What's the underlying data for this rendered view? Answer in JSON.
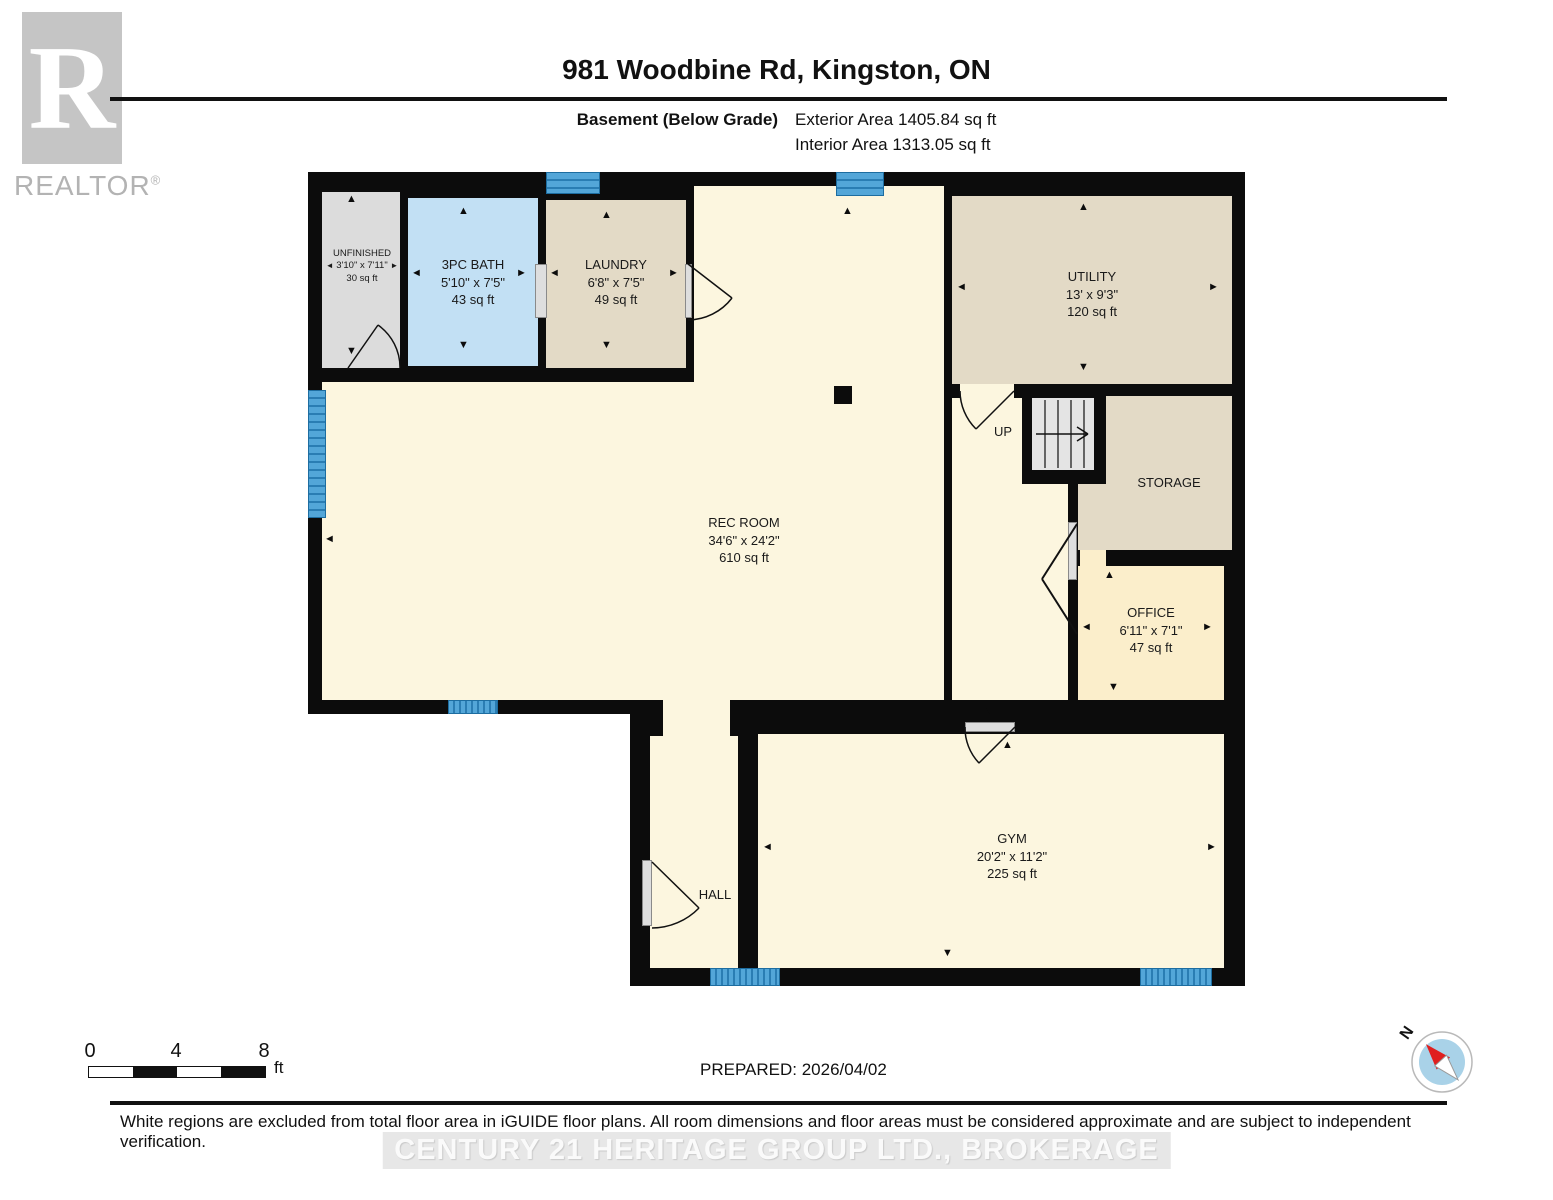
{
  "header": {
    "title": "981 Woodbine Rd, Kingston, ON",
    "floor_label": "Basement (Below Grade)",
    "exterior_area": "Exterior Area 1405.84 sq ft",
    "interior_area": "Interior Area 1313.05 sq ft",
    "logo_letter": "R",
    "logo_text": "REALTOR",
    "logo_mark": "®"
  },
  "rooms": [
    {
      "name": "UNFINISHED",
      "dims": "3'10\" x 7'11\"",
      "area": "30 sq ft"
    },
    {
      "name": "3PC BATH",
      "dims": "5'10\" x 7'5\"",
      "area": "43 sq ft"
    },
    {
      "name": "LAUNDRY",
      "dims": "6'8\" x 7'5\"",
      "area": "49 sq ft"
    },
    {
      "name": "UTILITY",
      "dims": "13' x 9'3\"",
      "area": "120 sq ft"
    },
    {
      "name": "REC ROOM",
      "dims": "34'6\" x 24'2\"",
      "area": "610 sq ft"
    },
    {
      "name": "STORAGE"
    },
    {
      "name": "OFFICE",
      "dims": "6'11\" x 7'1\"",
      "area": "47 sq ft"
    },
    {
      "name": "GYM",
      "dims": "20'2\" x 11'2\"",
      "area": "225 sq ft"
    },
    {
      "name": "HALL"
    },
    {
      "label": "UP"
    }
  ],
  "glyphs": {
    "up": "▲",
    "down": "▼",
    "left": "◄",
    "right": "►"
  },
  "footer": {
    "scale_ticks": [
      "0",
      "4",
      "8"
    ],
    "scale_unit": "ft",
    "prepared": "PREPARED: 2026/04/02",
    "compass_label": "N",
    "disclaimer": "White regions are excluded from total floor area in iGUIDE floor plans. All room dimensions and floor areas must be considered approximate and are subject to independent verification.",
    "watermark": "CENTURY 21 HERITAGE GROUP LTD., BROKERAGE"
  },
  "colors": {
    "wall": "#0c0c0c",
    "floor_cream": "#fcf6df",
    "floor_beige": "#e3dac6",
    "floor_blue": "#c2e0f4",
    "floor_grey": "#dcdcdc",
    "floor_office": "#fbeecb",
    "window_blue": "#53a6d8",
    "compass_red": "#e01f1f"
  }
}
